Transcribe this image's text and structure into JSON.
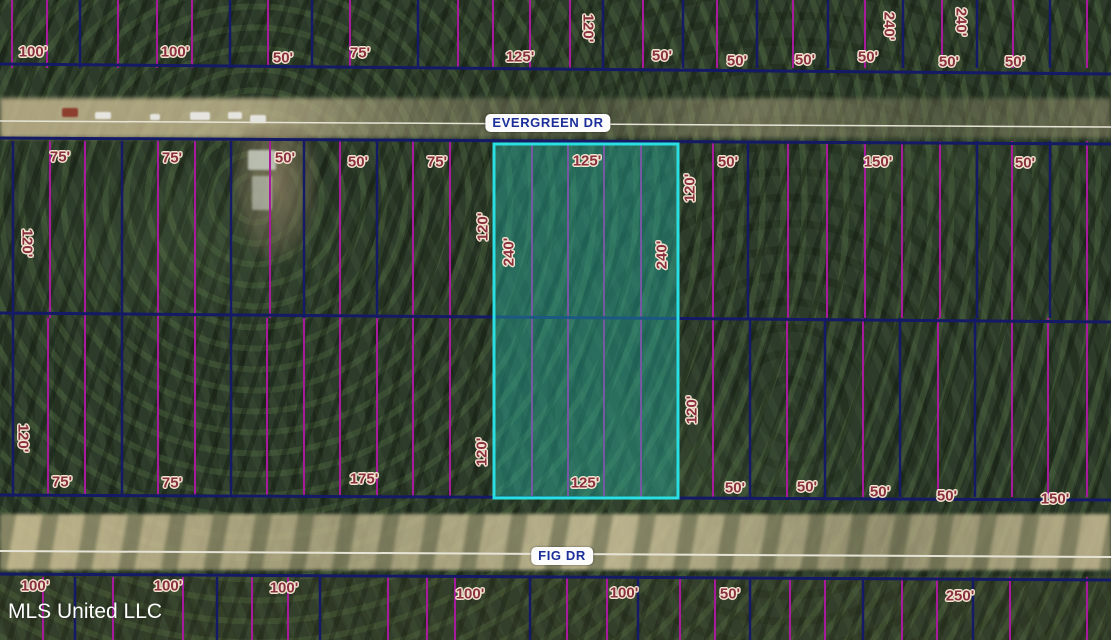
{
  "map": {
    "watermark": "MLS United LLC",
    "roads": {
      "evergreen": {
        "label": "EVERGREEN DR",
        "x": 548,
        "y": 123
      },
      "fig": {
        "label": "FIG DR",
        "x": 562,
        "y": 556
      }
    },
    "colors": {
      "parcel_navy": "#141a66",
      "lot_magenta": "#a81a9c",
      "highlight_cyan": "#2adfe2",
      "highlight_fill": "rgba(38,186,172,0.40)",
      "dimension_text": "#8a3040",
      "road_text": "#1d2f9a",
      "road_centerline": "#e6e4d6"
    },
    "highlight_lot": {
      "x": 494,
      "y": 144,
      "width": 184,
      "height": 354
    },
    "road_centerlines": [
      {
        "x1": 0,
        "y1": 121,
        "x2": 1111,
        "y2": 127,
        "width": 1.5
      },
      {
        "x1": 0,
        "y1": 551,
        "x2": 1111,
        "y2": 557,
        "width": 2
      }
    ],
    "parcel_lines": {
      "horizontals": [
        {
          "x1": 0,
          "y1": 64,
          "x2": 1111,
          "y2": 74
        },
        {
          "x1": 0,
          "y1": 138,
          "x2": 1111,
          "y2": 144
        },
        {
          "x1": 0,
          "y1": 313,
          "x2": 1111,
          "y2": 322
        },
        {
          "x1": 0,
          "y1": 495,
          "x2": 1111,
          "y2": 500
        },
        {
          "x1": 0,
          "y1": 574,
          "x2": 1111,
          "y2": 580
        }
      ],
      "blocks": [
        {
          "y1": 0,
          "y2": 68,
          "navy": [
            80,
            230,
            312,
            418,
            603,
            683,
            757,
            828,
            903,
            977,
            1050
          ],
          "magenta": [
            12,
            47,
            118,
            157,
            192,
            268,
            350,
            458,
            493,
            530,
            570,
            643,
            717,
            793,
            865,
            942,
            1013,
            1087
          ]
        },
        {
          "y1": 141,
          "y2": 318,
          "navy": [
            13,
            122,
            231,
            304,
            377,
            494,
            678,
            748,
            977,
            1050
          ],
          "magenta": [
            50,
            85,
            158,
            195,
            270,
            340,
            413,
            450,
            532,
            568,
            604,
            641,
            713,
            788,
            827,
            865,
            902,
            940,
            1012,
            1087
          ]
        },
        {
          "y1": 318,
          "y2": 497,
          "navy": [
            13,
            122,
            231,
            494,
            678,
            750,
            825,
            900,
            975
          ],
          "magenta": [
            48,
            85,
            158,
            195,
            267,
            304,
            340,
            377,
            413,
            450,
            532,
            568,
            604,
            641,
            713,
            787,
            863,
            938,
            1012,
            1048,
            1087
          ]
        },
        {
          "y1": 577,
          "y2": 640,
          "navy": [
            75,
            217,
            320,
            530,
            638,
            750,
            863,
            973
          ],
          "magenta": [
            43,
            113,
            183,
            252,
            288,
            388,
            427,
            455,
            567,
            607,
            680,
            715,
            790,
            825,
            902,
            937,
            1010,
            1087
          ]
        }
      ]
    },
    "dimension_labels": [
      {
        "text": "100'",
        "x": 33,
        "y": 52,
        "rot": 0
      },
      {
        "text": "100'",
        "x": 175,
        "y": 52,
        "rot": 0
      },
      {
        "text": "50'",
        "x": 283,
        "y": 58,
        "rot": 0
      },
      {
        "text": "75'",
        "x": 360,
        "y": 53,
        "rot": 0
      },
      {
        "text": "125'",
        "x": 520,
        "y": 57,
        "rot": 0
      },
      {
        "text": "120'",
        "x": 588,
        "y": 28,
        "rot": 90
      },
      {
        "text": "50'",
        "x": 662,
        "y": 56,
        "rot": 0
      },
      {
        "text": "50'",
        "x": 737,
        "y": 61,
        "rot": 0
      },
      {
        "text": "50'",
        "x": 805,
        "y": 60,
        "rot": 0
      },
      {
        "text": "50'",
        "x": 868,
        "y": 57,
        "rot": 0
      },
      {
        "text": "240'",
        "x": 889,
        "y": 26,
        "rot": 90
      },
      {
        "text": "50'",
        "x": 949,
        "y": 62,
        "rot": 0
      },
      {
        "text": "240'",
        "x": 961,
        "y": 22,
        "rot": 90
      },
      {
        "text": "50'",
        "x": 1015,
        "y": 62,
        "rot": 0
      },
      {
        "text": "75'",
        "x": 60,
        "y": 157,
        "rot": 0
      },
      {
        "text": "75'",
        "x": 172,
        "y": 158,
        "rot": 0
      },
      {
        "text": "50'",
        "x": 285,
        "y": 158,
        "rot": 0
      },
      {
        "text": "50'",
        "x": 358,
        "y": 162,
        "rot": 0
      },
      {
        "text": "75'",
        "x": 437,
        "y": 162,
        "rot": 0
      },
      {
        "text": "125'",
        "x": 587,
        "y": 161,
        "rot": 0
      },
      {
        "text": "50'",
        "x": 728,
        "y": 162,
        "rot": 0
      },
      {
        "text": "150'",
        "x": 878,
        "y": 162,
        "rot": 0
      },
      {
        "text": "50'",
        "x": 1025,
        "y": 163,
        "rot": 0
      },
      {
        "text": "120'",
        "x": 27,
        "y": 243,
        "rot": 90
      },
      {
        "text": "120'",
        "x": 483,
        "y": 227,
        "rot": -90
      },
      {
        "text": "240'",
        "x": 509,
        "y": 252,
        "rot": -90
      },
      {
        "text": "240'",
        "x": 662,
        "y": 255,
        "rot": -90
      },
      {
        "text": "120'",
        "x": 690,
        "y": 188,
        "rot": -90
      },
      {
        "text": "120'",
        "x": 23,
        "y": 438,
        "rot": 90
      },
      {
        "text": "75'",
        "x": 62,
        "y": 482,
        "rot": 0
      },
      {
        "text": "75'",
        "x": 172,
        "y": 483,
        "rot": 0
      },
      {
        "text": "175'",
        "x": 364,
        "y": 479,
        "rot": 0
      },
      {
        "text": "120'",
        "x": 482,
        "y": 452,
        "rot": -90
      },
      {
        "text": "125'",
        "x": 585,
        "y": 483,
        "rot": 0
      },
      {
        "text": "120'",
        "x": 692,
        "y": 410,
        "rot": -90
      },
      {
        "text": "50'",
        "x": 735,
        "y": 488,
        "rot": 0
      },
      {
        "text": "50'",
        "x": 807,
        "y": 487,
        "rot": 0
      },
      {
        "text": "50'",
        "x": 880,
        "y": 492,
        "rot": 0
      },
      {
        "text": "50'",
        "x": 947,
        "y": 496,
        "rot": 0
      },
      {
        "text": "150'",
        "x": 1055,
        "y": 499,
        "rot": 0
      },
      {
        "text": "100'",
        "x": 35,
        "y": 586,
        "rot": 0
      },
      {
        "text": "100'",
        "x": 168,
        "y": 586,
        "rot": 0
      },
      {
        "text": "100'",
        "x": 284,
        "y": 588,
        "rot": 0
      },
      {
        "text": "100'",
        "x": 470,
        "y": 594,
        "rot": 0
      },
      {
        "text": "100'",
        "x": 624,
        "y": 593,
        "rot": 0
      },
      {
        "text": "50'",
        "x": 730,
        "y": 594,
        "rot": 0
      },
      {
        "text": "250'",
        "x": 960,
        "y": 596,
        "rot": 0
      }
    ]
  }
}
